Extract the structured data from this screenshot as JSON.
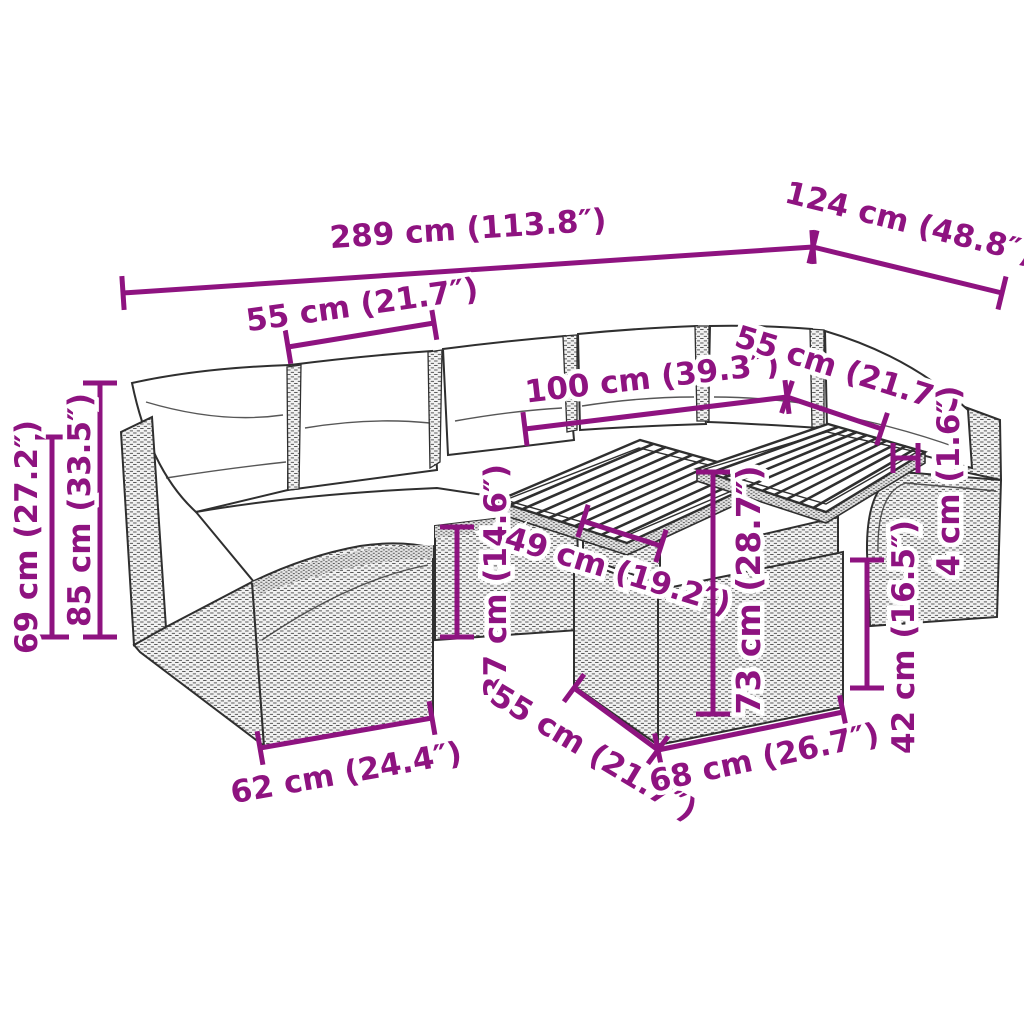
{
  "meta": {
    "description": "Dimension diagram of a poly rattan garden lounge set with cushions and a two-part slatted-top table"
  },
  "colors": {
    "dimension": "#8E1380",
    "line_art": "#2f2f2f",
    "background": "#ffffff"
  },
  "dimensions": [
    {
      "id": "total-width",
      "label": "289 cm (113.8″)",
      "line": [
        123,
        293,
        813,
        247
      ],
      "label_pos": [
        468,
        228
      ],
      "rotation": -3.7
    },
    {
      "id": "total-depth",
      "label": "124 cm (48.8″)",
      "line": [
        813,
        247,
        1002,
        293
      ],
      "label_pos": [
        910,
        222
      ],
      "rotation": 14
    },
    {
      "id": "seat-module-left",
      "label": "55 cm (21.7″)",
      "line": [
        288,
        347,
        434,
        323
      ],
      "label_pos": [
        362,
        304
      ],
      "rotation": -8
    },
    {
      "id": "table-length",
      "label": "100 cm (39.3″)",
      "line": [
        525,
        429,
        787,
        397
      ],
      "label_pos": [
        652,
        377
      ],
      "rotation": -6.5
    },
    {
      "id": "seat-module-right",
      "label": "55 cm (21.7″)",
      "line": [
        787,
        397,
        882,
        429
      ],
      "label_pos": [
        848,
        370
      ],
      "rotation": 17.5
    },
    {
      "id": "back-height",
      "label": "69 cm (27.2″)",
      "line": [
        52,
        437,
        52,
        637
      ],
      "label_pos": [
        26,
        537
      ],
      "rotation": -90
    },
    {
      "id": "total-height",
      "label": "85 cm (33.5″)",
      "line": [
        100,
        383,
        100,
        637
      ],
      "label_pos": [
        79,
        510
      ],
      "rotation": -90
    },
    {
      "id": "seat-height",
      "label": "37 cm (14.6″)",
      "line": [
        457,
        527,
        457,
        637
      ],
      "label_pos": [
        495,
        581
      ],
      "rotation": -90
    },
    {
      "id": "table-support-width",
      "label": "49 cm (19.2″)",
      "line": [
        583,
        521,
        661,
        546
      ],
      "label_pos": [
        618,
        570
      ],
      "rotation": 17
    },
    {
      "id": "table-height",
      "label": "73 cm (28.7″)",
      "line": [
        713,
        472,
        713,
        714
      ],
      "label_pos": [
        748,
        590
      ],
      "rotation": -90,
      "size": 33
    },
    {
      "id": "tabletop-gap",
      "label": "4 cm (1.6″)",
      "line": [
        893,
        458,
        918,
        458
      ],
      "label_pos": [
        948,
        481
      ],
      "rotation": -90,
      "tick": 15
    },
    {
      "id": "arm-height",
      "label": "42 cm (16.5″)",
      "line": [
        867,
        560,
        867,
        688
      ],
      "label_pos": [
        903,
        637
      ],
      "rotation": -90
    },
    {
      "id": "seat-depth-front",
      "label": "62 cm (24.4″)",
      "line": [
        260,
        748,
        432,
        718
      ],
      "label_pos": [
        346,
        772
      ],
      "rotation": -10
    },
    {
      "id": "table-base-depth",
      "label": "55 cm (21.7″)",
      "line": [
        574,
        688,
        658,
        750
      ],
      "label_pos": [
        594,
        752
      ],
      "rotation": 31
    },
    {
      "id": "table-base-width",
      "label": "68 cm (26.7″)",
      "line": [
        658,
        750,
        843,
        712
      ],
      "label_pos": [
        764,
        757
      ],
      "rotation": -12
    }
  ]
}
